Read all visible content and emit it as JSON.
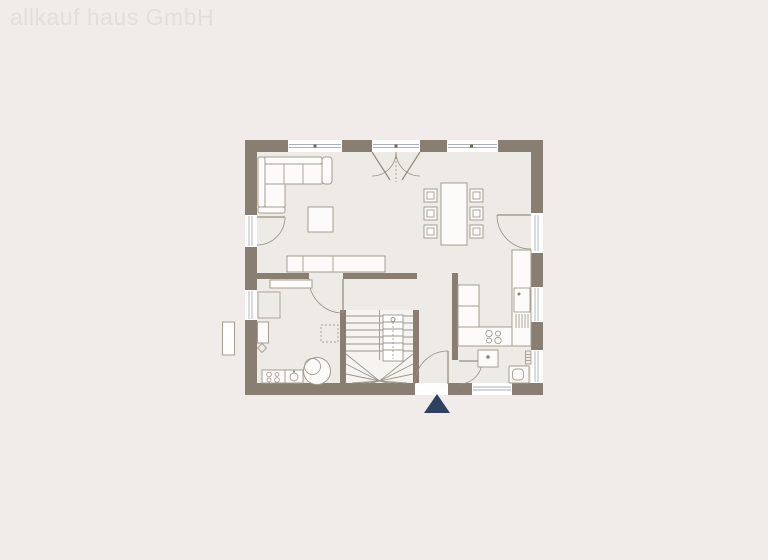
{
  "watermark": {
    "text": "allkauf haus GmbH"
  },
  "colors": {
    "background": "#f1ece9",
    "floor": "#eeeae6",
    "wall": "#897e72",
    "furniture": "#a69c90",
    "furniture_fill": "#fcfbf9",
    "glass": "#a9b2b9",
    "stair": "#9d9589",
    "door": "#988f84",
    "marker": "#2e4161",
    "watermark": "#e3dedb"
  },
  "floorplan": {
    "entrance_marker": {
      "shape": "triangle-up"
    }
  }
}
